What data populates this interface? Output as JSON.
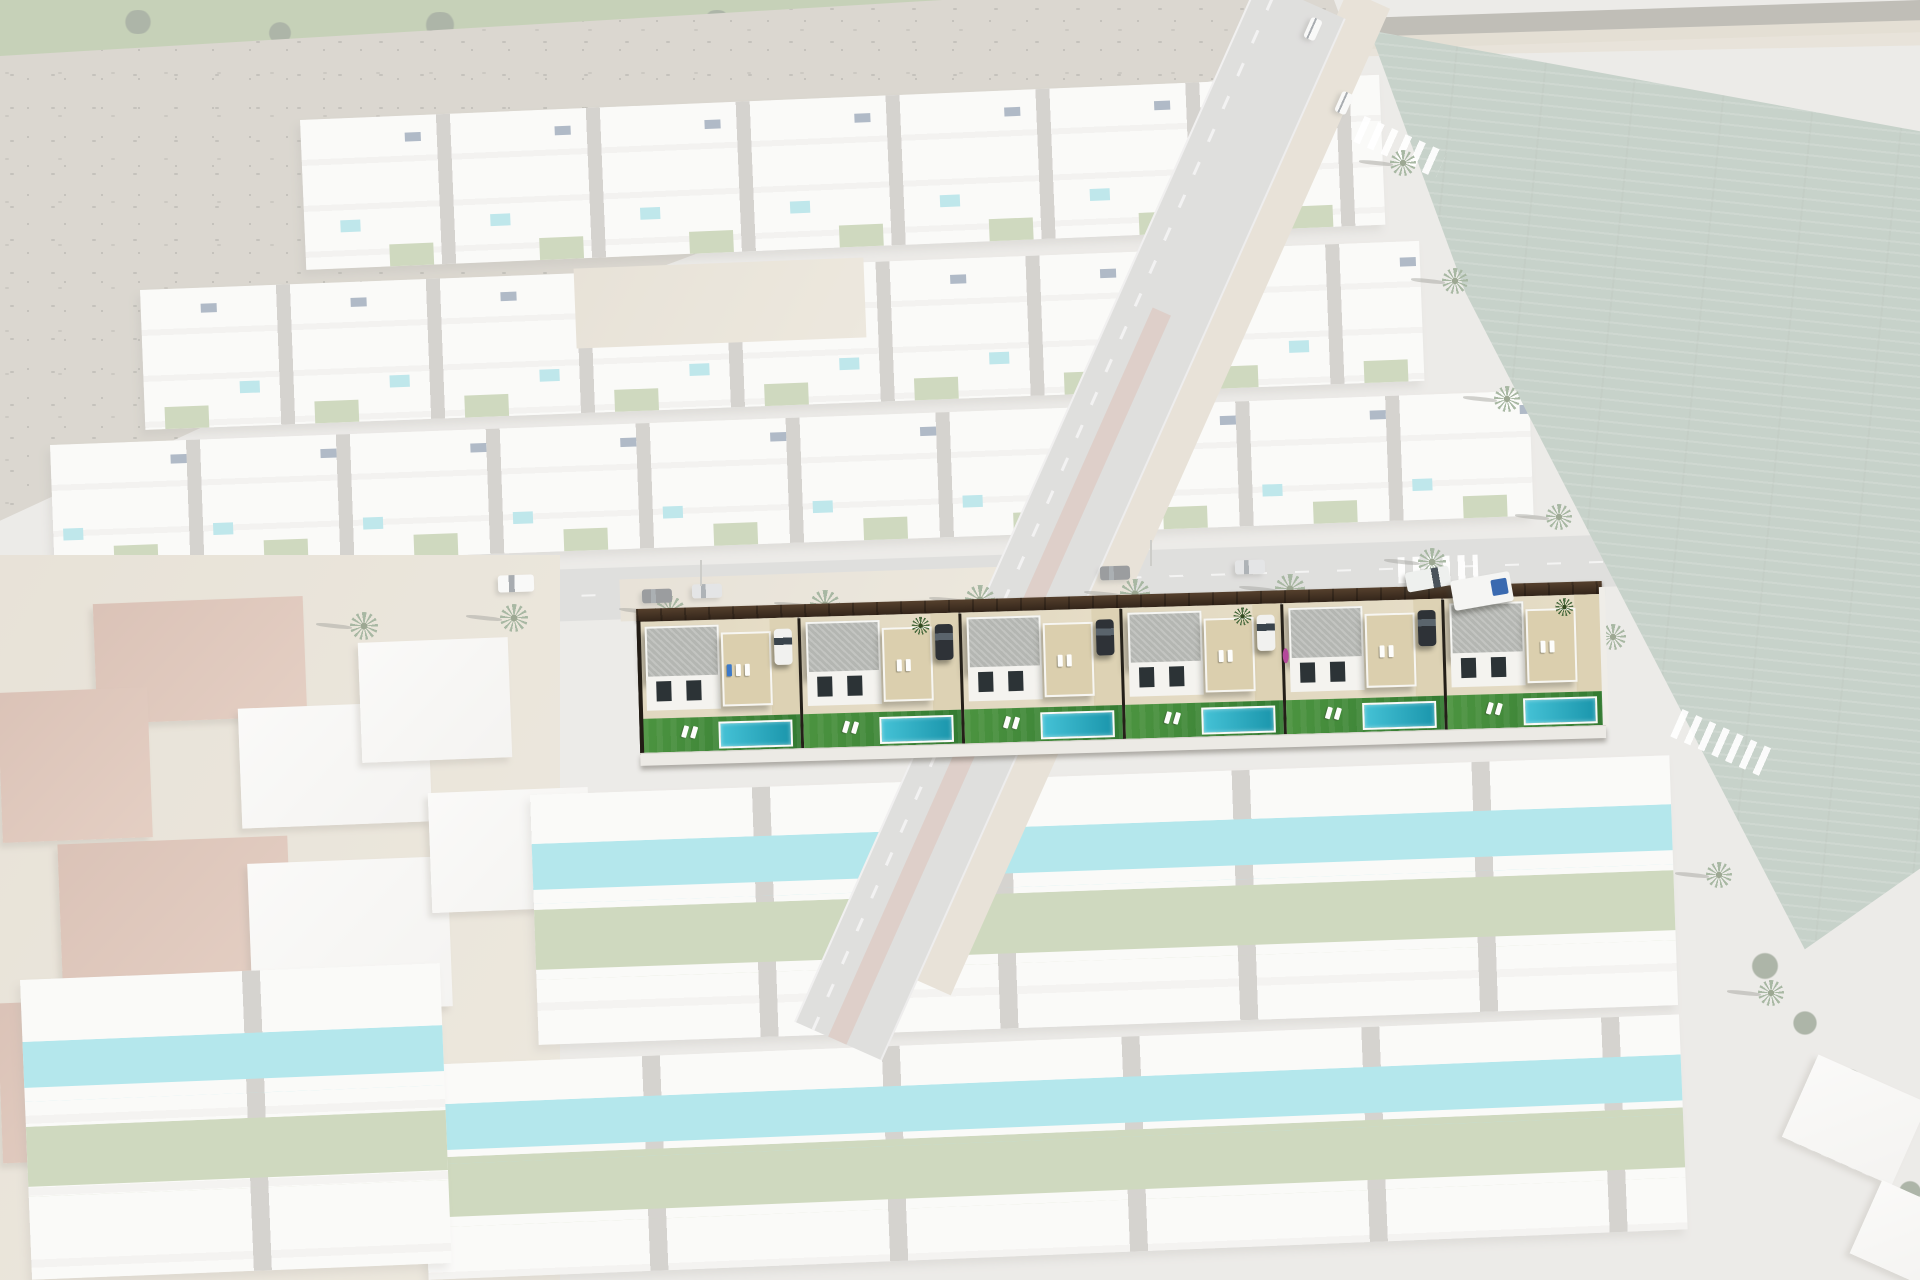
{
  "meta": {
    "description": "Aerial drone photograph of a Mediterranean residential development; the whole neighbourhood is washed out with a white overlay except one highlighted row of six newly rendered two-storey villas with timber street fence, beige solarium roof terraces, grey gravel roofs, parked cars, artificial lawns and private pools",
    "canvas": {
      "width": 1920,
      "height": 1280
    },
    "overlay": {
      "type": "white-fade",
      "opacity": 0.52
    }
  },
  "palette": {
    "base_sand": "#d8d5cf",
    "asphalt": "#bdbcb9",
    "house_white": "#f5f4f1",
    "house_shadow": "#a8a49c",
    "pool_faded": "#79ccd6",
    "pool_faded2": "#62cdd8",
    "lawn_faded": "#9cb079",
    "solar_panel": "#5a6f8a",
    "scrub": "#b3ac9d",
    "scrub_dark": "#7b776a",
    "field_green": "#8ba190",
    "dirt": "#cfc3ad",
    "golf_green": "#89a06b",
    "tree_dark": "#55654a",
    "tree": "#4a6b3f",
    "palm_core": "#33491f",
    "brick": "#b4826a",
    "median_clay": "#b99485",
    "yard_beige": "#e0d7bf",
    "vivid_roof": "#b4b6b2",
    "vivid_solarium": "#dbcfae",
    "vivid_lawn": "#4c9440",
    "vivid_lawn_dark": "#337a31",
    "vivid_pool": "#45c2d6",
    "vivid_pool_deep": "#1b96ac",
    "vivid_window": "#2c3336",
    "lounger_blue": "#3b79c9",
    "bougainvillea": "#b4499a",
    "truck_blue": "#3a6ab0"
  },
  "highlighted_development": {
    "units_count": 6,
    "street_fence": "dark timber slat fence along street",
    "rear_boundary": "white rear boundary wall",
    "unit_features": [
      "grey gravel flat roof",
      "beige gravel solarium with sun loungers",
      "dark glazed windows",
      "sand-coloured yard and driveway",
      "artificial lawn",
      "rectangular private pool with white coping",
      "two white pool loungers"
    ],
    "units": [
      {
        "plot": 1,
        "car": "white",
        "palm": false,
        "blue_lounger": true,
        "bougainvillea": false
      },
      {
        "plot": 2,
        "car": "dark",
        "palm": true,
        "blue_lounger": false,
        "bougainvillea": false
      },
      {
        "plot": 3,
        "car": "dark",
        "palm": false,
        "blue_lounger": false,
        "bougainvillea": false
      },
      {
        "plot": 4,
        "car": "white",
        "palm": true,
        "blue_lounger": false,
        "bougainvillea": false
      },
      {
        "plot": 5,
        "car": "dark",
        "palm": false,
        "blue_lounger": false,
        "bougainvillea": true
      },
      {
        "plot": 6,
        "car": null,
        "palm": true,
        "blue_lounger": false,
        "bougainvillea": false
      }
    ],
    "street_vehicles_at_corner": [
      {
        "type": "pickup",
        "color": "white"
      },
      {
        "type": "box-truck",
        "color": "white",
        "detail": "blue tarp load"
      }
    ]
  },
  "environment": {
    "golf_course_strip": {
      "position": "top-left",
      "trees": 5
    },
    "scrub_hillside": {
      "position": "upper-left",
      "texture": "dry scrub and sand"
    },
    "agricultural_field": {
      "position": "right",
      "texture": "crop rows"
    },
    "palm_lined_avenue": {
      "orientation": "diagonal top-to-bottom-right",
      "palms": 7,
      "crosswalks": 3,
      "median": "clay-coloured strip",
      "small_vehicles": 2
    },
    "main_street": {
      "orientation": "horizontal",
      "palms": 8,
      "lamp_posts": 2,
      "vehicles": [
        {
          "type": "van",
          "color": "white"
        },
        {
          "type": "car",
          "color": "dark"
        },
        {
          "type": "car",
          "color": "silver"
        },
        {
          "type": "car",
          "color": "dark"
        },
        {
          "type": "car",
          "color": "silver"
        }
      ]
    },
    "faded_villa_rows_upper": 3,
    "faded_villa_rows_lower": 3,
    "construction_zone": {
      "position": "bottom-left",
      "brick_shells": 4,
      "white_shells": 4,
      "ground": "sand"
    },
    "sand_lots": 2,
    "corner_trees_bottom_right": 5
  }
}
